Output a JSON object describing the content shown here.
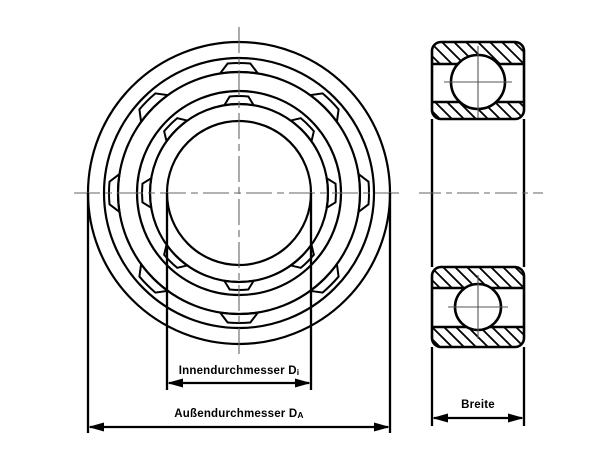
{
  "drawing": {
    "kind": "ball-bearing-technical-drawing"
  },
  "labels": {
    "inner_diameter": "Innendurchmesser D",
    "inner_diameter_sub": "i",
    "outer_diameter": "Außendurchmesser D",
    "outer_diameter_sub": "A",
    "width": "Breite"
  },
  "colors": {
    "background": "#ffffff",
    "stroke": "#000000",
    "centerline": "#666666",
    "crosshair": "#555555"
  }
}
